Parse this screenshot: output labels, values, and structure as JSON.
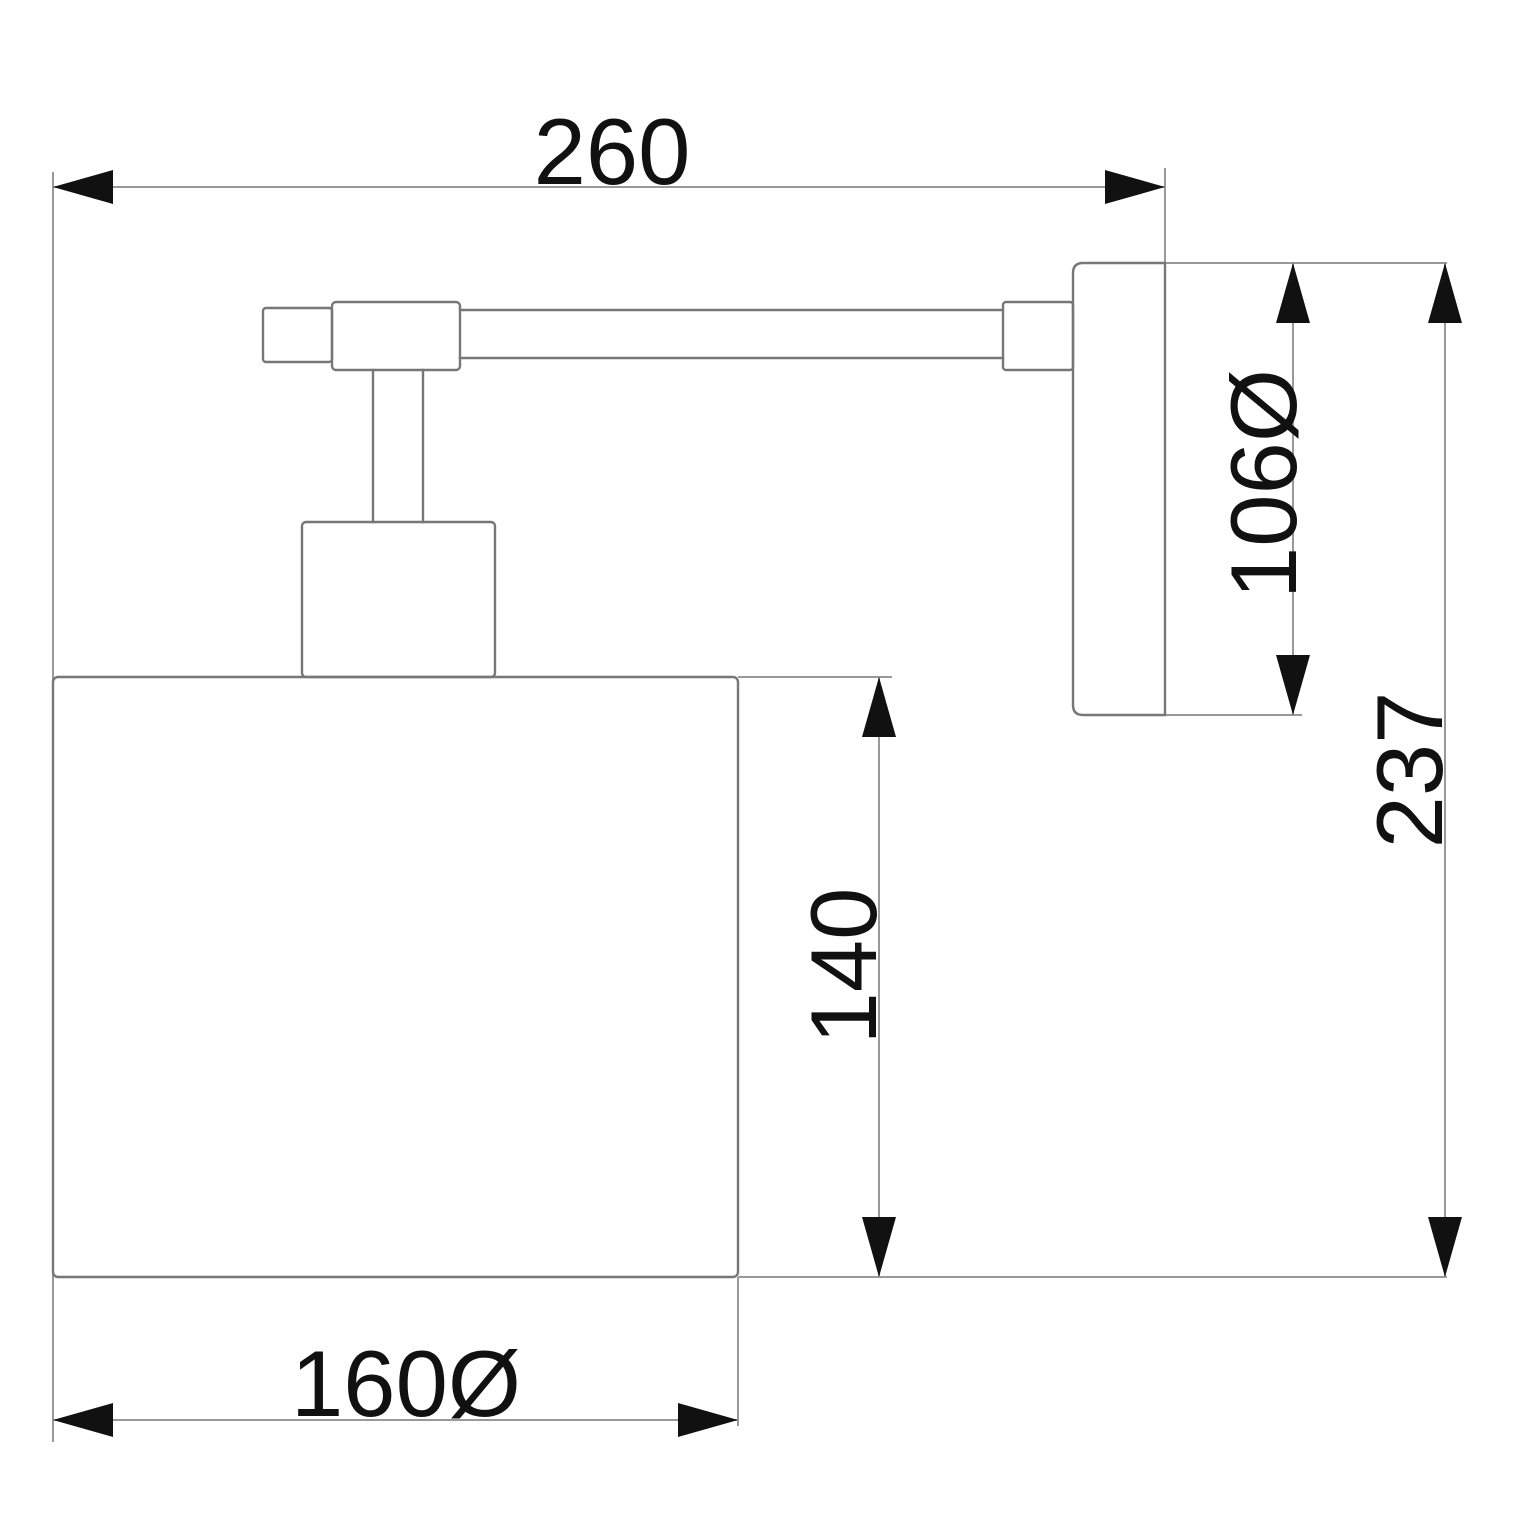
{
  "colors": {
    "background": "#ffffff",
    "object_line": "#777777",
    "dim_line": "#999999",
    "ink": "#111111"
  },
  "drawing": {
    "kind": "technical-dimension-drawing",
    "dimensions": {
      "overall_width": {
        "label": "260"
      },
      "backplate_diameter": {
        "label": "106Ø"
      },
      "overall_height": {
        "label": "237"
      },
      "shade_height": {
        "label": "140"
      },
      "shade_diameter": {
        "label": "160Ø"
      }
    }
  }
}
